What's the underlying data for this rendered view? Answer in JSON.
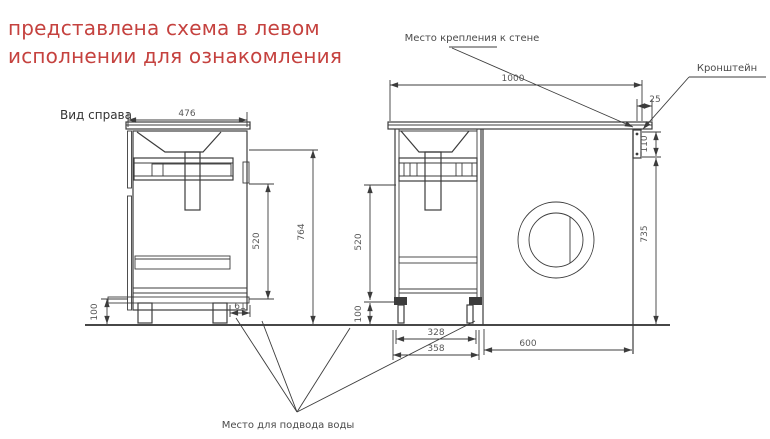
{
  "title": {
    "line1": "представлена схема в левом",
    "line2": "исполнении для ознакомления"
  },
  "view_label": "Вид справа",
  "labels": {
    "wall_mount": "Место крепления к стене",
    "bracket": "Кронштейн",
    "water_supply": "Место для подвода воды"
  },
  "dimensions": {
    "side_view": {
      "width": "476",
      "inner_height": "520",
      "total_height": "764",
      "leg_height": "100",
      "water_offset": "61"
    },
    "front_view": {
      "countertop_width": "1000",
      "countertop_overhang": "25",
      "bracket_height": "110",
      "under_top_height": "735",
      "inner_height": "520",
      "leg_height": "100",
      "cabinet_inner_width": "328",
      "cabinet_width": "358",
      "machine_space_width": "600"
    }
  },
  "colors": {
    "title_red": "#c5423f",
    "line": "#3c3c3c",
    "dim_text": "#585858",
    "label_text": "#4a4a4a"
  }
}
